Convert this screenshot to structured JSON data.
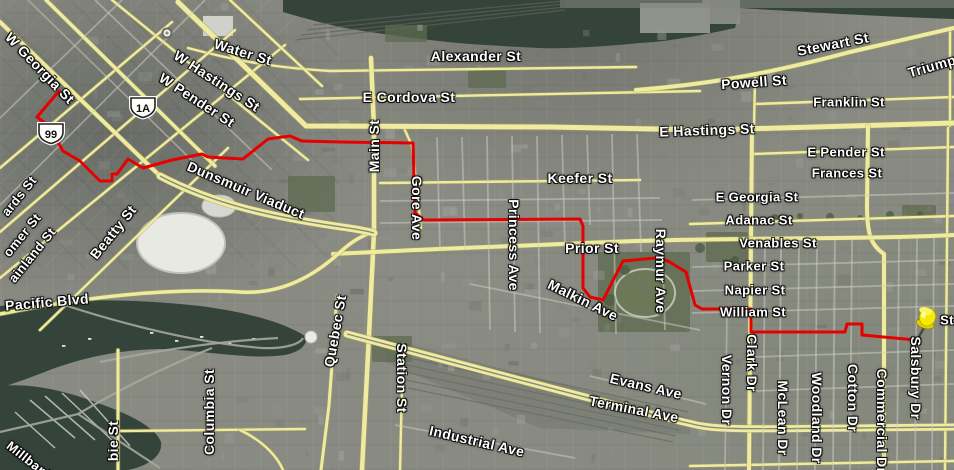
{
  "meta": {
    "description": "Satellite road map with driving route and destination pushpin",
    "city_area": "Vancouver downtown to Grandview"
  },
  "colors": {
    "route": "#e60000",
    "road_yellow": "#efec9f",
    "water": "#35443a",
    "marker_yellow": "#f2e400",
    "label_text": "#ffffff"
  },
  "route": {
    "name": "driving-route",
    "points": "59,91 37,117 49,126 63,151 80,161 100,181 112,181 112,174 117,174 128,159 143,168 172,160 202,154 208,157 243,159 268,139 290,136 302,141 340,142 413,143 415,213 424,220 580,219 583,226 583,288 590,297 603,300 623,261 656,258 668,261 686,272 695,305 702,309 751,309 751,332 845,332 847,324 862,324 862,335 905,339 916,340"
  },
  "marker": {
    "kind": "yellow-pushpin",
    "x": 917,
    "y": 340
  },
  "transit_station": {
    "x": 167,
    "y": 33
  },
  "shields": [
    {
      "label": "99",
      "x": 51,
      "y": 134
    },
    {
      "label": "1A",
      "x": 143,
      "y": 108
    }
  ],
  "labels": [
    {
      "t": "W Georgia St",
      "x": 40,
      "y": 68,
      "r": 46,
      "s": 14
    },
    {
      "t": "Water St",
      "x": 243,
      "y": 52,
      "r": 17,
      "s": 14
    },
    {
      "t": "W Hastings St",
      "x": 217,
      "y": 81,
      "r": 33,
      "s": 14
    },
    {
      "t": "W Pender St",
      "x": 197,
      "y": 100,
      "r": 33,
      "s": 14
    },
    {
      "t": "Alexander St",
      "x": 476,
      "y": 56,
      "r": 0,
      "s": 14
    },
    {
      "t": "E Cordova St",
      "x": 409,
      "y": 97,
      "r": 0,
      "s": 14
    },
    {
      "t": "Powell St",
      "x": 754,
      "y": 82,
      "r": -4,
      "s": 14
    },
    {
      "t": "Stewart St",
      "x": 833,
      "y": 44,
      "r": -11,
      "s": 14
    },
    {
      "t": "Triump",
      "x": 932,
      "y": 66,
      "r": -16,
      "s": 14
    },
    {
      "t": "Franklin St",
      "x": 849,
      "y": 102,
      "r": 0,
      "s": 13
    },
    {
      "t": "E Hastings St",
      "x": 707,
      "y": 130,
      "r": -2,
      "s": 14
    },
    {
      "t": "E Pender St",
      "x": 846,
      "y": 152,
      "r": 0,
      "s": 13
    },
    {
      "t": "Frances St",
      "x": 847,
      "y": 173,
      "r": 0,
      "s": 13
    },
    {
      "t": "Keefer St",
      "x": 580,
      "y": 178,
      "r": 0,
      "s": 14
    },
    {
      "t": "E Georgia St",
      "x": 757,
      "y": 197,
      "r": 0,
      "s": 13
    },
    {
      "t": "Adanac St",
      "x": 759,
      "y": 220,
      "r": 0,
      "s": 13
    },
    {
      "t": "Venables St",
      "x": 778,
      "y": 243,
      "r": 0,
      "s": 13
    },
    {
      "t": "Prior St",
      "x": 592,
      "y": 248,
      "r": 0,
      "s": 14
    },
    {
      "t": "Parker St",
      "x": 754,
      "y": 266,
      "r": 0,
      "s": 13
    },
    {
      "t": "Napier St",
      "x": 755,
      "y": 290,
      "r": 0,
      "s": 13
    },
    {
      "t": "William St",
      "x": 753,
      "y": 312,
      "r": 0,
      "s": 13
    },
    {
      "t": "Malkin Ave",
      "x": 583,
      "y": 300,
      "r": 26,
      "s": 14
    },
    {
      "t": "Dunsmuir Viaduct",
      "x": 246,
      "y": 190,
      "r": 23,
      "s": 14
    },
    {
      "t": "Pacific Blvd",
      "x": 47,
      "y": 302,
      "r": -5,
      "s": 14
    },
    {
      "t": "Evans Ave",
      "x": 646,
      "y": 386,
      "r": 13,
      "s": 14
    },
    {
      "t": "Terminal Ave",
      "x": 634,
      "y": 409,
      "r": 11,
      "s": 14
    },
    {
      "t": "Industrial Ave",
      "x": 477,
      "y": 441,
      "r": 13,
      "s": 14
    },
    {
      "t": "Millbank",
      "x": 30,
      "y": 461,
      "r": 38,
      "s": 13
    },
    {
      "t": "ards St",
      "x": 19,
      "y": 196,
      "r": -51,
      "s": 13
    },
    {
      "t": "omer St",
      "x": 22,
      "y": 235,
      "r": -51,
      "s": 13
    },
    {
      "t": "ainland St",
      "x": 32,
      "y": 255,
      "r": -51,
      "s": 13
    },
    {
      "t": "Beatty St",
      "x": 113,
      "y": 232,
      "r": -51,
      "s": 14
    },
    {
      "t": "St",
      "x": 947,
      "y": 320,
      "r": 0,
      "s": 13
    },
    {
      "t": "Gore Ave",
      "x": 417,
      "y": 208,
      "r": 90,
      "s": 14
    },
    {
      "t": "Princess Ave",
      "x": 514,
      "y": 245,
      "r": 90,
      "s": 14
    },
    {
      "t": "Raymur Ave",
      "x": 661,
      "y": 271,
      "r": 90,
      "s": 14
    },
    {
      "t": "Vernon Dr",
      "x": 727,
      "y": 390,
      "r": 90,
      "s": 14
    },
    {
      "t": "Clark Dr",
      "x": 752,
      "y": 363,
      "r": 90,
      "s": 14
    },
    {
      "t": "McLean Dr",
      "x": 783,
      "y": 418,
      "r": 90,
      "s": 14
    },
    {
      "t": "Woodland Dr",
      "x": 817,
      "y": 418,
      "r": 90,
      "s": 14
    },
    {
      "t": "Cotton Dr",
      "x": 853,
      "y": 398,
      "r": 90,
      "s": 14
    },
    {
      "t": "Commercial Dr",
      "x": 882,
      "y": 421,
      "r": 90,
      "s": 14
    },
    {
      "t": "Salsbury Dr",
      "x": 916,
      "y": 378,
      "r": 90,
      "s": 14
    },
    {
      "t": "Station St",
      "x": 402,
      "y": 378,
      "r": 90,
      "s": 14
    },
    {
      "t": "Main St",
      "x": 374,
      "y": 146,
      "r": -90,
      "s": 14
    },
    {
      "t": "Quebec St",
      "x": 335,
      "y": 331,
      "r": -80,
      "s": 14
    },
    {
      "t": "Columbia St",
      "x": 209,
      "y": 412,
      "r": -90,
      "s": 14
    },
    {
      "t": "bie St",
      "x": 113,
      "y": 441,
      "r": -90,
      "s": 14
    }
  ]
}
